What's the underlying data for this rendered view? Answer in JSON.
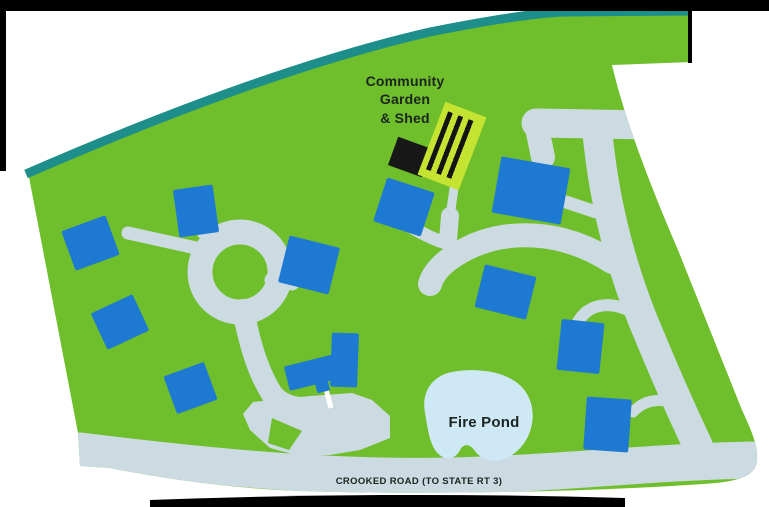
{
  "page": {
    "background": "#ffffff",
    "frame_color": "#000000"
  },
  "map": {
    "type": "community-site-plan",
    "labels": {
      "garden_line1": "Community",
      "garden_line2": "Garden",
      "garden_line3": "& Shed",
      "fire_pond": "Fire Pond",
      "crooked_road": "CROOKED ROAD (TO STATE RT 3)"
    },
    "colors": {
      "land": "#6fbe2c",
      "treeline": "#1e8e8a",
      "road": "#ccdae1",
      "house": "#1e79d3",
      "pond": "#cfe8f6",
      "garden_fill": "#c4e431",
      "garden_stripe": "#141414",
      "shed": "#181818",
      "driveway_white": "#ffffff",
      "label_text": "#1c2420"
    },
    "houses": [
      {
        "x": 90,
        "y": 243,
        "w": 47,
        "h": 42,
        "r": -20
      },
      {
        "x": 196,
        "y": 211,
        "w": 40,
        "h": 48,
        "r": -8
      },
      {
        "x": 120,
        "y": 322,
        "w": 46,
        "h": 40,
        "r": -25
      },
      {
        "x": 190,
        "y": 388,
        "w": 43,
        "h": 40,
        "r": -20
      },
      {
        "x": 309,
        "y": 265,
        "w": 52,
        "h": 48,
        "r": 14
      },
      {
        "x": 404,
        "y": 207,
        "w": 50,
        "h": 46,
        "r": 18
      },
      {
        "x": 531,
        "y": 190,
        "w": 70,
        "h": 57,
        "r": 10
      },
      {
        "x": 505,
        "y": 292,
        "w": 53,
        "h": 44,
        "r": 14
      },
      {
        "x": 580,
        "y": 346,
        "w": 43,
        "h": 51,
        "r": 6
      },
      {
        "x": 607,
        "y": 424,
        "w": 45,
        "h": 53,
        "r": 4
      }
    ],
    "clubhouse_wings": [
      {
        "x": 316,
        "y": 371,
        "w": 60,
        "h": 25,
        "r": -14
      },
      {
        "x": 344,
        "y": 360,
        "w": 27,
        "h": 54,
        "r": 2
      },
      {
        "x": 322,
        "y": 386,
        "w": 13,
        "h": 11,
        "r": -14
      }
    ],
    "garden": {
      "x": 452,
      "y": 146,
      "w": 44,
      "h": 78,
      "r": 21
    },
    "shed": {
      "x": 410,
      "y": 157,
      "w": 36,
      "h": 30,
      "r": 20
    }
  }
}
